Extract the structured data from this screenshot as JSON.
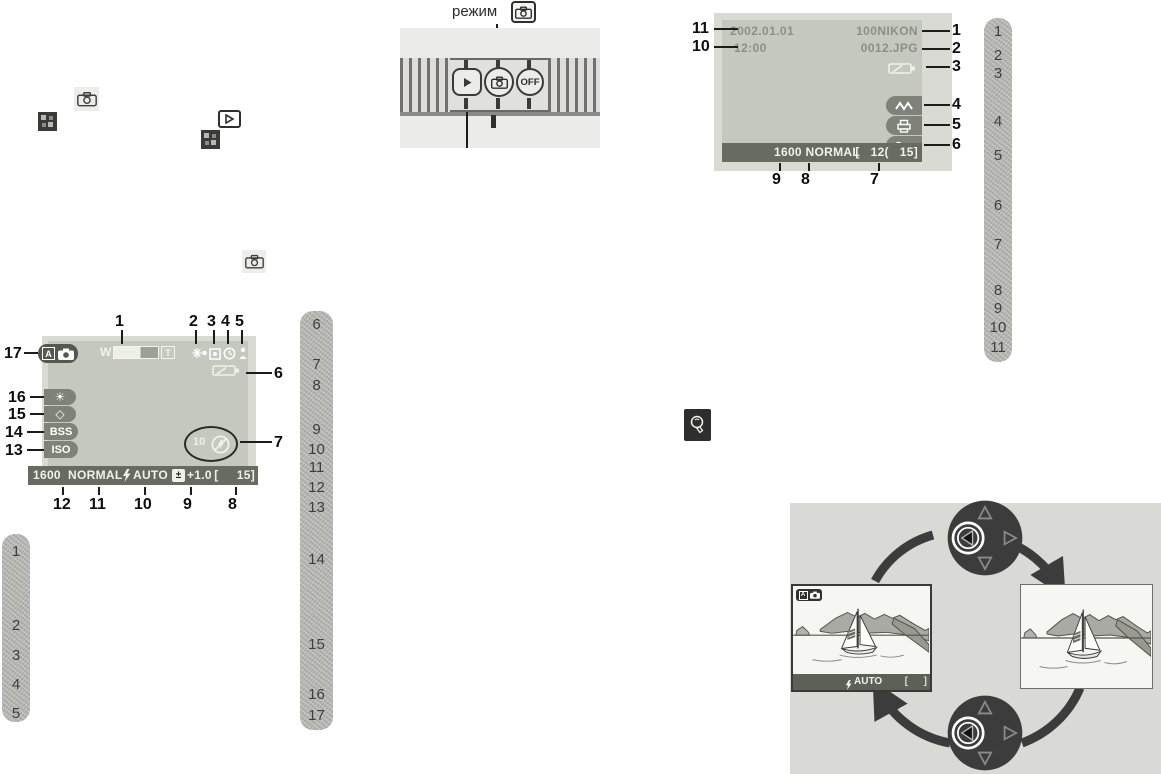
{
  "dial": {
    "label": "режим",
    "off_label": "OFF"
  },
  "playback": {
    "date": "2002.01.01",
    "time": "12:00",
    "folder": "100NIKON",
    "filename": "0012.JPG",
    "bar_text": "1600 NORMAL",
    "frame_text": "[   12(   15]",
    "callouts": [
      "1",
      "2",
      "3",
      "4",
      "5",
      "6",
      "7",
      "8",
      "9",
      "10",
      "11"
    ]
  },
  "shooting": {
    "mode_letter": "A",
    "zoom_wide": "W",
    "zoom_tele": "T",
    "bss": "BSS",
    "iso": "ISO",
    "timer": "10",
    "bar_size": "1600",
    "bar_quality": "NORMAL",
    "bar_flash": "AUTO",
    "bar_exposure": "+1.0",
    "bar_frame": "[     15]",
    "callouts": [
      "1",
      "2",
      "3",
      "4",
      "5",
      "6",
      "7",
      "8",
      "9",
      "10",
      "11",
      "12",
      "13",
      "14",
      "15",
      "16",
      "17"
    ]
  },
  "cycle": {
    "mode_letter": "A",
    "bar_flash": "AUTO",
    "bracket_left": "[",
    "bracket_right": "]"
  },
  "strips": {
    "right": [
      "1",
      "2",
      "3",
      "4",
      "5",
      "6",
      "7",
      "8",
      "9",
      "10",
      "11"
    ],
    "left": [
      "1",
      "2",
      "3",
      "4",
      "5"
    ],
    "middle": [
      "6",
      "7",
      "8",
      "9",
      "10",
      "11",
      "12",
      "13",
      "14",
      "15",
      "16",
      "17"
    ]
  },
  "icons": {
    "wb_sun": "☀",
    "sharpen": "◇",
    "exposure": "±"
  },
  "colors": {
    "lcd_bg": "#c5c8be",
    "bar_bg": "#676b62",
    "strip_bg": "#b6b6b2",
    "dark": "#3c3c3c"
  }
}
